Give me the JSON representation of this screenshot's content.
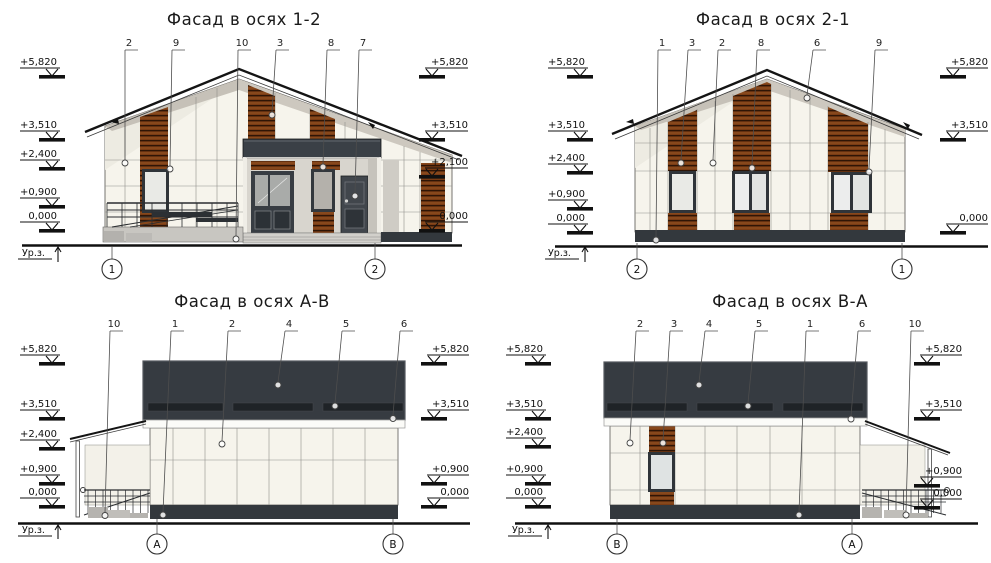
{
  "sheet": {
    "background": "#ffffff",
    "line_color": "#1c1c1c",
    "wall_color": "#f6f4ec",
    "wood_color": "#7a3c15",
    "dark_band_color": "#3a4046",
    "plinth_color": "#33383d"
  },
  "facades": {
    "f12": {
      "title": "Фасад в осях 1-2",
      "callouts": [
        "2",
        "9",
        "10",
        "3",
        "8",
        "7"
      ],
      "elev_left": [
        "+5,820",
        "+3,510",
        "+2,400",
        "+0,900",
        "0,000"
      ],
      "elev_right": [
        "+5,820",
        "+3,510",
        "+2,100",
        "0,000"
      ],
      "axis_left": "1",
      "axis_right": "2",
      "ground_label": "Ур.з."
    },
    "f21": {
      "title": "Фасад в осях 2-1",
      "callouts": [
        "1",
        "3",
        "2",
        "8",
        "6",
        "9"
      ],
      "elev_left": [
        "+5,820",
        "+3,510",
        "+2,400",
        "+0,900",
        "0,000"
      ],
      "elev_right": [
        "+5,820",
        "+3,510",
        "0,000"
      ],
      "axis_left": "2",
      "axis_right": "1",
      "ground_label": "Ур.з."
    },
    "fAB": {
      "title": "Фасад в осях А-В",
      "callouts": [
        "10",
        "1",
        "2",
        "4",
        "5",
        "6"
      ],
      "elev_left": [
        "+5,820",
        "+3,510",
        "+2,400",
        "+0,900",
        "0,000"
      ],
      "elev_right": [
        "+5,820",
        "+3,510",
        "+0,900",
        "0,000"
      ],
      "axis_left": "А",
      "axis_right": "В",
      "ground_label": "Ур.з."
    },
    "fBA": {
      "title": "Фасад в осях В-А",
      "callouts": [
        "2",
        "3",
        "4",
        "5",
        "1",
        "6",
        "10"
      ],
      "elev_left": [
        "+5,820",
        "+3,510",
        "+2,400",
        "+0,900",
        "0,000"
      ],
      "elev_right": [
        "+5,820",
        "+3,510",
        "+0,900",
        "0,000"
      ],
      "axis_left": "В",
      "axis_right": "А",
      "ground_label": "Ур.з."
    }
  }
}
